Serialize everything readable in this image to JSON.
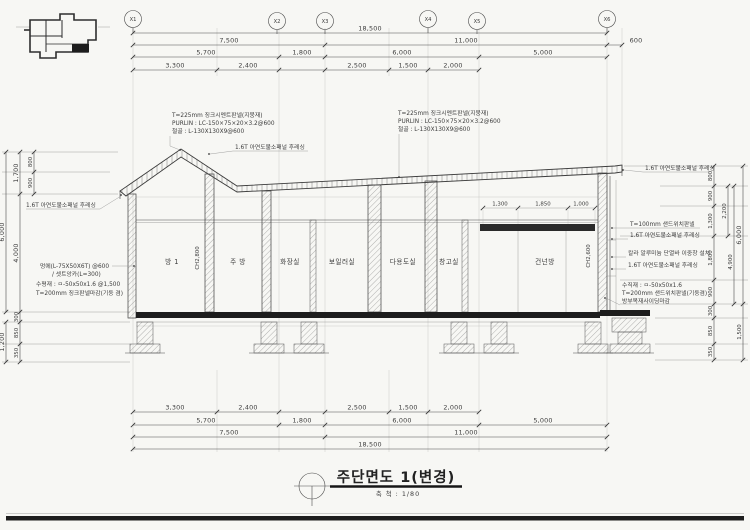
{
  "title": {
    "main": "주단면도 1(변경)",
    "scale": "축 척 : 1/80"
  },
  "grid": {
    "labels": [
      "X1",
      "X2",
      "X3",
      "X4",
      "X5",
      "X6"
    ]
  },
  "dims": {
    "top": {
      "overall": "18,500",
      "row2": [
        "7,500",
        "11,000"
      ],
      "overhang": "600",
      "row3": [
        "5,700",
        "1,800",
        "6,000",
        "5,000"
      ],
      "row4": [
        "3,300",
        "2,400",
        "2,500",
        "1,500",
        "2,000"
      ]
    },
    "left": {
      "v800": "800",
      "v900": "900",
      "v1700": "1,700",
      "v4000": "4,000",
      "v6000": "6,000",
      "v300": "300",
      "v850": "850",
      "v350": "350",
      "v1200": "1,200"
    },
    "right": {
      "v800": "800",
      "v900_upper": "900",
      "v1300": "1,300",
      "v1800": "1,800",
      "v900_lower": "900",
      "v2200": "2,200",
      "v4900": "4,900",
      "v6000": "6,000",
      "v300": "300",
      "v850": "850",
      "v350": "350",
      "v1500": "1,500"
    },
    "window": [
      "1,300",
      "1,850",
      "1,000"
    ]
  },
  "rooms": {
    "labels": [
      "방 1",
      "주 방",
      "화장실",
      "보일러실",
      "다용도실",
      "창고실",
      "건넌방"
    ],
    "ch_left": "CH2,800",
    "ch_right": "CH2,600"
  },
  "notes": {
    "roof_block": [
      "T=225mm 징크시멘트판넬(지붕재)",
      "PURLIN : LC-150×75×20×3.2@600",
      "철골 : L-130X130X9@600"
    ],
    "flashing": "1.6T 아연도불소패널 후레싱",
    "sandwich100": "T=100mm 샌드위치판넬",
    "window_note": "칼라 알루미늄 단열바 이중창 설치",
    "vertical_member": "수직재 : ㅁ-50x50x1.6",
    "sandwich200": "T=200mm 샌드위치판넬(기둥겸)",
    "siding": "방부목재사이딩마감",
    "left_block": [
      "멍에(L-75X50X6T) @600",
      "/ 셋트앙카(L=300)",
      "수평재 : ㅁ-50x50x1.6 @1,500",
      "T=200mm 징크판넬마감(기둥 겸)"
    ]
  }
}
